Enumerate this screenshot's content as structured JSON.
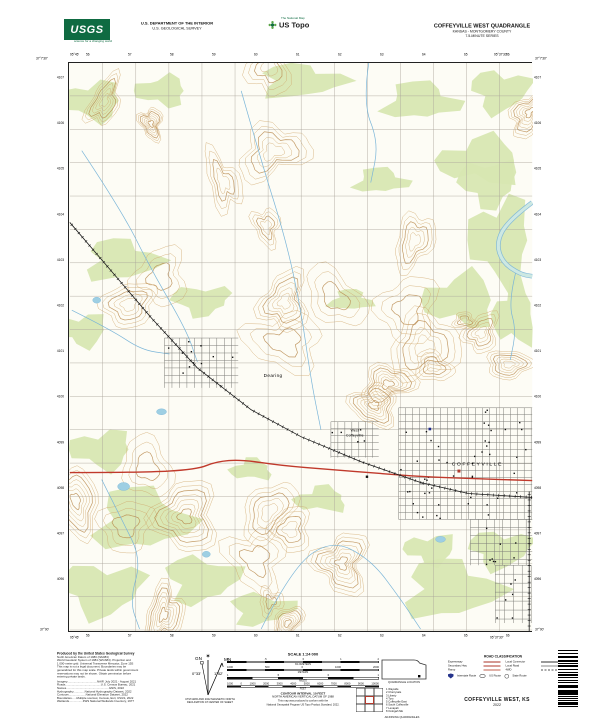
{
  "header": {
    "agency_line1": "U.S. DEPARTMENT OF THE INTERIOR",
    "agency_line2": "U.S. GEOLOGICAL SURVEY",
    "usgs_logo_text": "USGS",
    "usgs_logo_tagline": "science for a changing world",
    "ustopo_brand": "US Topo",
    "ustopo_subbrand": "The National Map",
    "quad_title": "COFFEYVILLE WEST QUADRANGLE",
    "quad_subtitle": "KANSAS - MONTGOMERY COUNTY",
    "quad_series": "7.5-MINUTE SERIES"
  },
  "map": {
    "colors": {
      "background": "#fdfcf5",
      "contour": "#cfa468",
      "contour_index": "#b98a4e",
      "woodland": "#d8e7b2",
      "water": "#7ab5d8",
      "water_fill": "#cde8e2",
      "road": "#aaa49a",
      "highway": "#c0392b",
      "rail": "#1a1a1a"
    },
    "corner_labels": [
      {
        "text": "37°7'30\"",
        "x": 36,
        "y": 57
      },
      {
        "text": "95°45'",
        "x": 70,
        "y": 53
      },
      {
        "text": "95°37'30\"",
        "x": 494,
        "y": 53
      },
      {
        "text": "37°7'30\"",
        "x": 535,
        "y": 57
      },
      {
        "text": "37°00'",
        "x": 40,
        "y": 628
      },
      {
        "text": "95°45'",
        "x": 70,
        "y": 636
      },
      {
        "text": "95°37'30\"",
        "x": 490,
        "y": 636
      },
      {
        "text": "37°00'",
        "x": 535,
        "y": 628
      }
    ],
    "top_grid": [
      "56",
      "57",
      "58",
      "59",
      "60",
      "61",
      "62",
      "63",
      "64",
      "65",
      "66"
    ],
    "bottom_grid": [
      "56",
      "57",
      "58",
      "59",
      "60",
      "61",
      "62",
      "63",
      "64",
      "65",
      "66"
    ],
    "left_grid": [
      "4107",
      "4106",
      "4105",
      "4104",
      "4103",
      "4102",
      "4101",
      "4100",
      "4099",
      "4098",
      "4097",
      "4096"
    ],
    "right_grid": [
      "4107",
      "4106",
      "4105",
      "4104",
      "4103",
      "4102",
      "4101",
      "4100",
      "4099",
      "4098",
      "4097",
      "4096"
    ],
    "place_labels": [
      {
        "text": "Dearing",
        "x": 204,
        "y": 315,
        "size": 4.6,
        "spacing": 0.4
      },
      {
        "text": "West",
        "x": 286,
        "y": 370,
        "size": 3.4,
        "spacing": 0.2
      },
      {
        "text": "Coffeyville",
        "x": 286,
        "y": 375,
        "size": 3.4,
        "spacing": 0.2
      },
      {
        "text": "COFFEYVILLE",
        "x": 409,
        "y": 404,
        "size": 5,
        "spacing": 1.6
      }
    ],
    "woodland": [
      [
        22,
        38,
        30,
        18
      ],
      [
        92,
        28,
        25,
        14
      ],
      [
        232,
        18,
        40,
        16
      ],
      [
        352,
        38,
        35,
        18
      ],
      [
        432,
        28,
        28,
        20
      ],
      [
        412,
        98,
        40,
        22
      ],
      [
        432,
        178,
        30,
        40
      ],
      [
        392,
        238,
        35,
        25
      ],
      [
        52,
        198,
        35,
        20
      ],
      [
        12,
        268,
        25,
        15
      ],
      [
        132,
        238,
        28,
        14
      ],
      [
        32,
        388,
        30,
        18
      ],
      [
        72,
        458,
        45,
        30
      ],
      [
        32,
        528,
        40,
        25
      ],
      [
        132,
        518,
        35,
        22
      ],
      [
        192,
        548,
        30,
        15
      ],
      [
        252,
        438,
        25,
        12
      ],
      [
        182,
        408,
        20,
        10
      ],
      [
        382,
        528,
        45,
        28
      ],
      [
        432,
        488,
        30,
        18
      ],
      [
        312,
        118,
        25,
        12
      ],
      [
        282,
        238,
        20,
        10
      ],
      [
        420,
        120,
        28,
        22
      ],
      [
        446,
        252,
        20,
        30
      ],
      [
        362,
        488,
        25,
        14
      ]
    ],
    "streams": [
      [
        [
          12,
          88
        ],
        [
          52,
          148
        ],
        [
          82,
          208
        ],
        [
          117,
          268
        ],
        [
          128,
          300
        ]
      ],
      [
        [
          172,
          28
        ],
        [
          192,
          98
        ],
        [
          217,
          178
        ],
        [
          232,
          248
        ],
        [
          242,
          318
        ],
        [
          252,
          368
        ]
      ],
      [
        [
          192,
          568
        ],
        [
          222,
          508
        ],
        [
          262,
          478
        ],
        [
          302,
          498
        ],
        [
          332,
          538
        ],
        [
          352,
          568
        ]
      ],
      [
        [
          32,
          418
        ],
        [
          52,
          458
        ],
        [
          72,
          498
        ],
        [
          60,
          540
        ],
        [
          70,
          568
        ]
      ],
      [
        [
          2,
          248
        ],
        [
          42,
          268
        ],
        [
          72,
          288
        ],
        [
          100,
          292
        ]
      ],
      [
        [
          448,
          208
        ],
        [
          440,
          240
        ],
        [
          448,
          268
        ],
        [
          442,
          298
        ]
      ],
      [
        [
          300,
          0
        ],
        [
          294,
          40
        ],
        [
          310,
          80
        ],
        [
          302,
          120
        ]
      ]
    ],
    "river": [
      [
        464,
        140
      ],
      [
        440,
        158
      ],
      [
        428,
        180
      ],
      [
        434,
        200
      ],
      [
        452,
        212
      ],
      [
        464,
        214
      ]
    ],
    "ponds": [
      [
        54,
        425,
        6,
        4
      ],
      [
        27,
        238,
        4,
        3
      ],
      [
        372,
        478,
        5,
        3
      ],
      [
        137,
        493,
        4,
        3
      ],
      [
        92,
        350,
        5,
        3
      ]
    ],
    "railroads": [
      [
        [
          0,
          160
        ],
        [
          82,
          256
        ],
        [
          128,
          306
        ],
        [
          182,
          348
        ],
        [
          232,
          375
        ],
        [
          292,
          400
        ],
        [
          352,
          421
        ],
        [
          400,
          432
        ],
        [
          464,
          436
        ]
      ],
      [
        [
          461,
          430
        ],
        [
          461,
          570
        ]
      ]
    ],
    "highways": [
      [
        [
          0,
          411
        ],
        [
          72,
          411
        ],
        [
          127,
          408
        ],
        [
          147,
          400
        ],
        [
          172,
          398
        ],
        [
          212,
          404
        ],
        [
          262,
          408
        ],
        [
          312,
          412
        ],
        [
          352,
          415
        ],
        [
          402,
          417
        ],
        [
          464,
          419
        ]
      ]
    ],
    "city_grids": [
      {
        "x": 330,
        "y": 346,
        "w": 134,
        "h": 112,
        "s": 7
      },
      {
        "x": 402,
        "y": 458,
        "w": 62,
        "h": 46,
        "s": 8
      },
      {
        "x": 427,
        "y": 504,
        "w": 36,
        "h": 58,
        "s": 9
      },
      {
        "x": 95,
        "y": 276,
        "w": 74,
        "h": 50,
        "s": 7.5
      },
      {
        "x": 262,
        "y": 360,
        "w": 48,
        "h": 36,
        "s": 7
      }
    ],
    "landmarks": [
      {
        "x": 389,
        "y": 408,
        "c": "#b03a2e",
        "s": 3
      },
      {
        "x": 360,
        "y": 366,
        "c": "#1f2a8c",
        "s": 2.6
      },
      {
        "x": 297,
        "y": 414,
        "c": "#111111",
        "s": 2.4
      }
    ]
  },
  "footer": {
    "credits_title": "Produced by the United States Geological Survey",
    "credits": [
      "North American Datum of 1983 (NAD83)",
      "World Geodetic System of 1984 (WGS84).  Projection and",
      "1 000-meter grid: Universal Transverse Mercator, Zone 15S",
      "This map is not a legal document. Boundaries may be",
      "generalized for this map scale. Private lands within government",
      "reservations may not be shown. Obtain permission before",
      "entering private lands."
    ],
    "sources": [
      "Imagery.....................................NAIP, July 2021 - August 2021",
      "Roads............................................U.S. Census Bureau, 2021",
      "Names.....................................................GNIS, 2022",
      "Hydrography..............National Hydrography Dataset, 2022",
      "Contours.....................National Elevation Dataset, 2022",
      "Boundaries......Multiple sources; Census, Esri, USGS, 2022",
      "Wetlands.................FWS National Wetlands Inventory, 1977"
    ],
    "scale_title": "SCALE 1:24 000",
    "scale_bars": [
      {
        "unit": "KILOMETERS",
        "ticks": [
          "1",
          ".5",
          "0",
          "1",
          "2"
        ],
        "segs": 8
      },
      {
        "unit": "METERS",
        "ticks": [
          "1000",
          "500",
          "0",
          "1000",
          "2000"
        ],
        "segs": 8
      },
      {
        "unit": "MILES",
        "ticks": [
          "1",
          ".5",
          "0",
          "1"
        ],
        "segs": 6
      },
      {
        "unit": "FEET",
        "ticks": [
          "1000",
          "0",
          "1000",
          "2000",
          "3000",
          "4000",
          "5000",
          "6000",
          "7000",
          "8000",
          "9000",
          "10000"
        ],
        "segs": 11
      }
    ],
    "contour_note1": "CONTOUR INTERVAL 10 FEET",
    "contour_note2": "NORTH AMERICAN VERTICAL DATUM OF 1988",
    "standard_note1": "This map was produced to conform with the",
    "standard_note2": "National Geospatial Program US Topo Product Standard, 2022.",
    "declination": {
      "star": "✶",
      "mn": "MN",
      "gn": "GN",
      "mn_val": "1°52'",
      "gn_val": "0°33'",
      "caption1": "UTM GRID AND 2022 MAGNETIC NORTH",
      "caption2": "DECLINATION AT CENTER OF SHEET"
    },
    "quadloc_caption": "QUADRANGLE LOCATION",
    "adjoining_caption": "ADJOINING QUADRANGLES",
    "adjoining_names": [
      "Wayside",
      "Cherryvale",
      "Liberty",
      "Tyro",
      "Coffeyville East",
      "South Coffeyville",
      "Lenapah",
      "Oologah NE"
    ],
    "road_class": {
      "title": "ROAD CLASSIFICATION",
      "left": [
        {
          "label": "Expressway",
          "style": "exp"
        },
        {
          "label": "Secondary Hwy",
          "style": "sec"
        },
        {
          "label": "Ramp",
          "style": "ramp"
        }
      ],
      "right": [
        {
          "label": "Local Connector",
          "style": "conn"
        },
        {
          "label": "Local Road",
          "style": "local"
        },
        {
          "label": "4WD",
          "style": "fwd"
        }
      ],
      "shields": [
        {
          "type": "interstate",
          "label": "Interstate Route"
        },
        {
          "type": "us",
          "label": "US Route"
        },
        {
          "type": "state",
          "label": "State Route"
        }
      ]
    },
    "map_name": "COFFEYVILLE WEST, KS",
    "map_year": "2022"
  }
}
